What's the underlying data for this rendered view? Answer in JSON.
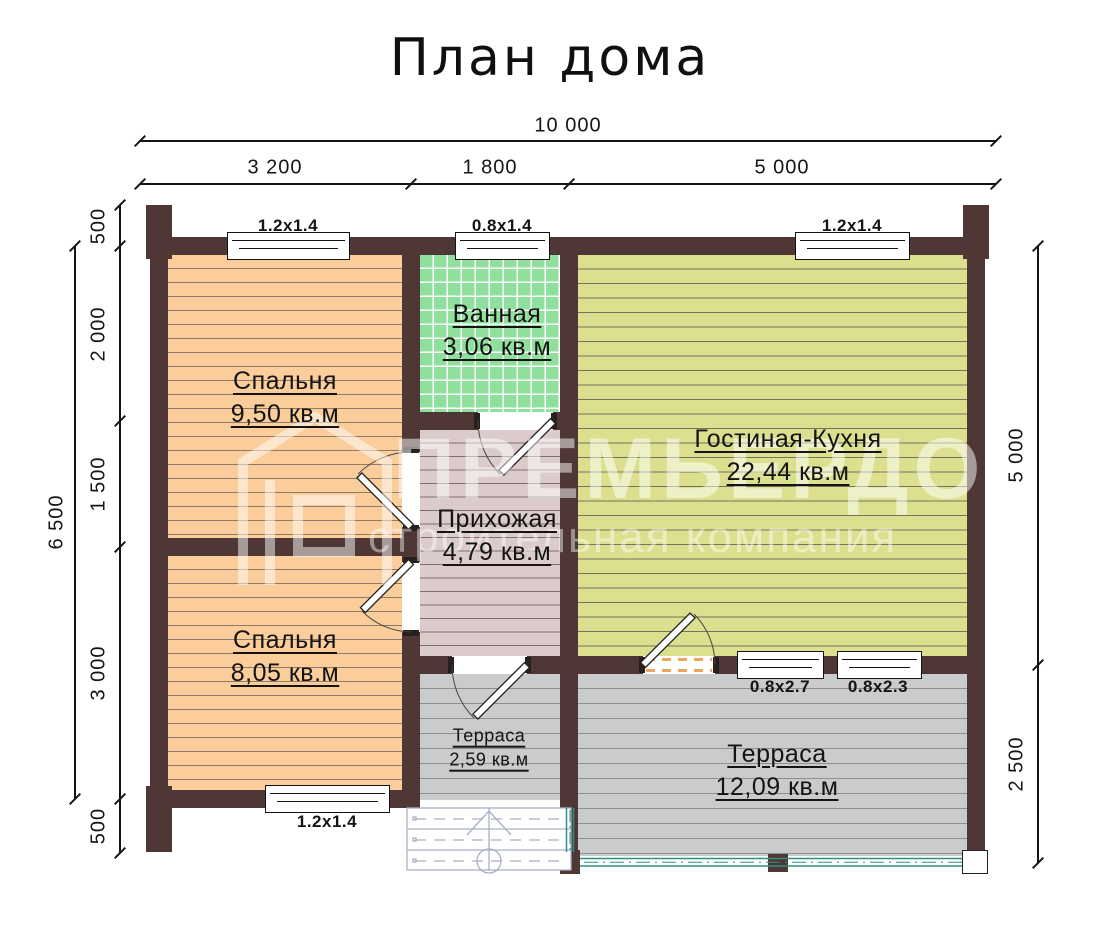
{
  "title": "План дома",
  "dimensions": {
    "top_total": "10 000",
    "top_segments": [
      "3 200",
      "1 800",
      "5 000"
    ],
    "left_total": "6 500",
    "left_segments": [
      "500",
      "2 000",
      "1 500",
      "3 000",
      "500"
    ],
    "right_segments": [
      "5 000",
      "2 500"
    ]
  },
  "rooms": [
    {
      "name": "Спальня",
      "area": "9,50 кв.м"
    },
    {
      "name": "Ванная",
      "area": "3,06 кв.м"
    },
    {
      "name": "Гостиная-Кухня",
      "area": "22,44 кв.м"
    },
    {
      "name": "Прихожая",
      "area": "4,79 кв.м"
    },
    {
      "name": "Спальня",
      "area": "8,05 кв.м"
    },
    {
      "name": "Терраса",
      "area": "2,59 кв.м"
    },
    {
      "name": "Терраса",
      "area": "12,09 кв.м"
    }
  ],
  "windows": {
    "bedroom1_top": "1.2x1.4",
    "bathroom_top": "0.8x1.4",
    "living_top": "1.2x1.4",
    "bedroom2_bottom": "1.2x1.4",
    "terrace_window_left": "0.8x2.7",
    "terrace_window_right": "0.8x2.3"
  },
  "watermark": {
    "brand": "ПРЕМЬЕРДОМ",
    "tagline": "строительная компания"
  },
  "colors": {
    "wall": "#4E3734",
    "bedroom": "#FBCD9A",
    "bedroom_line": "#8D7B68",
    "bathroom": "#8FDF9D",
    "living": "#DCE08E",
    "living_line": "#73735E",
    "hallway": "#DCCBCB",
    "hallway_line": "#7E6F6F",
    "terrace": "#CACBCC",
    "terrace_line": "#8E8F90",
    "railing": "#2E9080",
    "door_threshold": "#F2A35E",
    "porch_line": "#A9AFC6",
    "watermark": "rgba(255,255,255,0.5)"
  }
}
